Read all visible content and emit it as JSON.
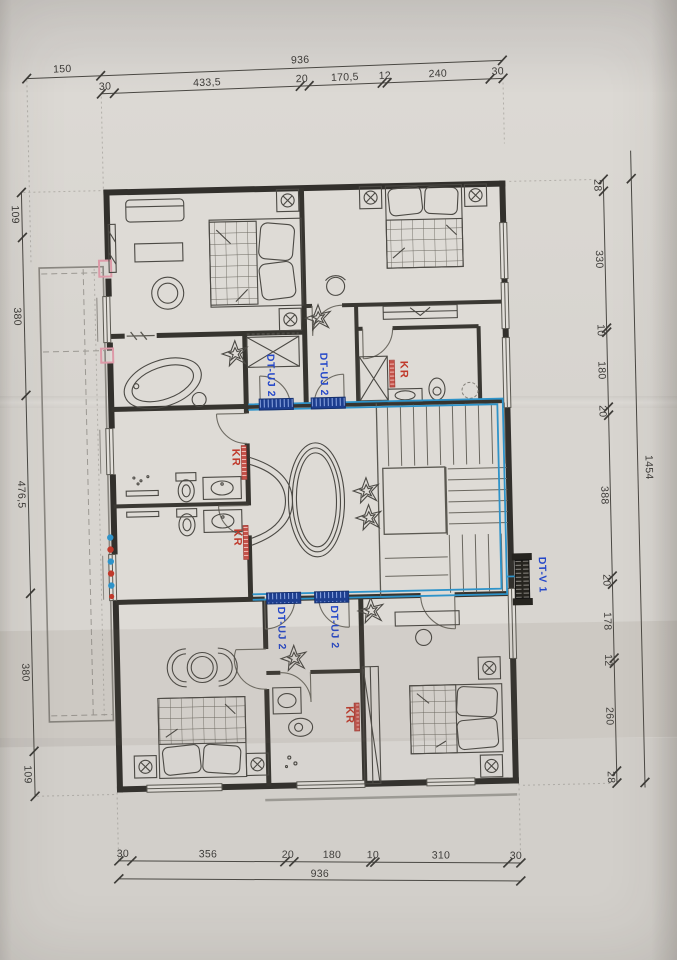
{
  "labels": {
    "unit_label": "DT-UJ 2",
    "outdoor_unit_label": "DT-V 1",
    "radiator_label": "KR"
  },
  "dimensions": {
    "top": {
      "left_offset": "150",
      "overall": "936",
      "chain": [
        "30",
        "433,5",
        "20",
        "170,5",
        "12",
        "240",
        "30"
      ]
    },
    "bottom": {
      "overall": "936",
      "chain": [
        "30",
        "356",
        "20",
        "180",
        "10",
        "310",
        "30"
      ]
    },
    "left": {
      "chain": [
        "109",
        "380",
        "476,5",
        "380",
        "109"
      ]
    },
    "right": {
      "overall": "1454",
      "chain": [
        "28",
        "330",
        "10",
        "180",
        "20",
        "388",
        "20",
        "178",
        "12",
        "260",
        "28"
      ]
    }
  },
  "colors": {
    "pipe_blue": "#2e93c9",
    "radiator_navy": "#1d3e8f",
    "label_blue": "#2447c9",
    "kr_red": "#c0392b",
    "pink_mark": "#dd9aa8"
  }
}
